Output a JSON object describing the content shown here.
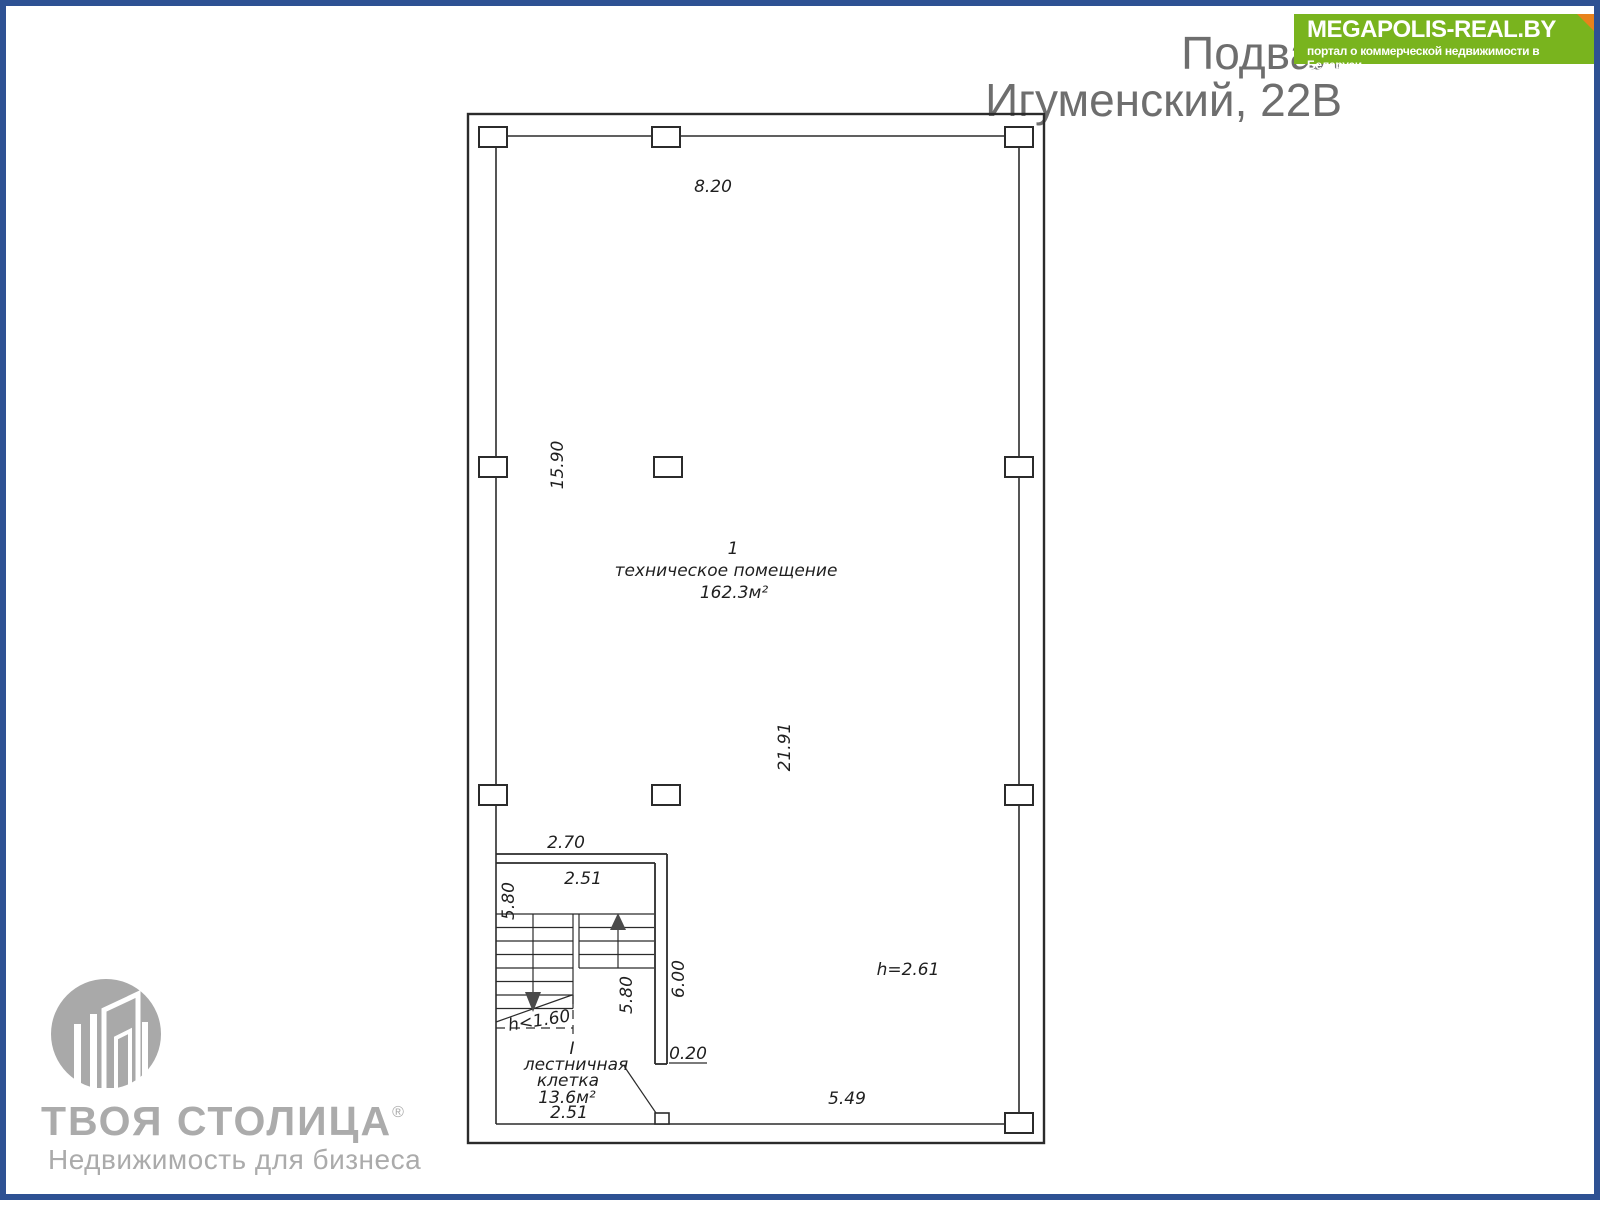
{
  "page": {
    "background": "#ffffff",
    "border_color": "#2e5193"
  },
  "header": {
    "line1": "Подвал",
    "line2": "Игуменский, 22В",
    "text_color": "#6e6e6e"
  },
  "badge": {
    "title": "MEGAPOLIS-REAL.BY",
    "subtitle": "портал о коммерческой недвижимости в Беларуси",
    "bg_color": "#79b41e",
    "fold_color": "#e8821c",
    "text_color": "#ffffff"
  },
  "watermark": {
    "brand": "ТВОЯ СТОЛИЦА",
    "reg": "®",
    "tagline": "Недвижимость для бизнеса",
    "color": "#ababab"
  },
  "plan": {
    "line_color": "#2b2b2b",
    "room_main": {
      "number": "1",
      "name": "техническое помещение",
      "area": "162.3м²"
    },
    "room_stairs": {
      "number": "I",
      "name_line1": "лестничная",
      "name_line2": "клетка",
      "area": "13.6м²"
    },
    "dims": {
      "top_width": "8.20",
      "left_height": "15.90",
      "inner_height": "21.91",
      "stair_outer_width": "2.70",
      "stair_inner_width": "2.51",
      "stair_left_height": "5.80",
      "stair_inner_height": "5.80",
      "stair_wall_height": "6.00",
      "wall_opening": "0.20",
      "bottom_width": "5.49",
      "stair_bottom_width": "2.51",
      "ceiling_height": "h=2.61",
      "under_stair_height": "h<1.60"
    }
  }
}
